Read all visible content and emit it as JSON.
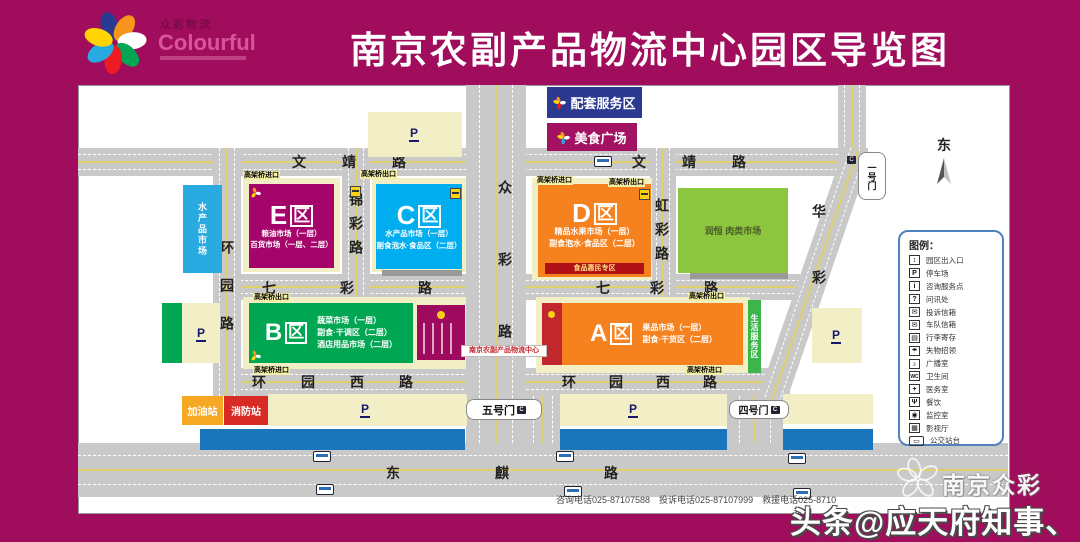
{
  "title": "南京农副产品物流中心园区导览图",
  "logo": {
    "cn": "众彩物流",
    "en": "Colourful"
  },
  "compass": {
    "east": "东"
  },
  "top_facilities": {
    "service_area": "配套服务区",
    "food_plaza": "美食广场"
  },
  "zones": {
    "E": {
      "letter": "E",
      "qu": "区",
      "lines": [
        "粮油市场（一层）",
        "百货市场（一层、二层）"
      ]
    },
    "C": {
      "letter": "C",
      "qu": "区",
      "lines": [
        "水产品市场（一层）",
        "副食泡水·食品区（二层）"
      ]
    },
    "D": {
      "letter": "D",
      "qu": "区",
      "lines": [
        "精品水果市场（一层）",
        "副食泡水·食品区（二层）"
      ],
      "strip": "食品惠民专区"
    },
    "B": {
      "letter": "B",
      "qu": "区",
      "lines": [
        "蔬菜市场（一层）",
        "副食·干调区（二层）",
        "酒店用品市场（二层）"
      ]
    },
    "A": {
      "letter": "A",
      "qu": "区",
      "lines": [
        "果品市场（一层）",
        "副食·干货区（二层）"
      ]
    }
  },
  "blocks": {
    "aquatic_market": "水产品市场",
    "runheng_meat_market": "润恒 肉类市场",
    "life_service_strip": "生活服务区",
    "gas_station": "加油站",
    "fire_station": "消防站",
    "center_banner": "南京农副产品物流中心"
  },
  "roads": {
    "wenjing": "文靖路",
    "qicai": "七彩路",
    "huanyuan_west": "环园西路",
    "dongqi": "东麒路",
    "huanyuan": "环园路",
    "jincai": "锦彩路",
    "zhongcai": "众彩路",
    "hongcai": "虹彩路",
    "huacai": "华彩"
  },
  "gates": {
    "gate1": "一号门",
    "gate4": "四号门",
    "gate5": "五号门"
  },
  "ramps": {
    "entry": "高架桥进口",
    "exit": "高架桥出口"
  },
  "parking_label": "P",
  "legend": {
    "title": "图例：",
    "items": [
      {
        "glyph": "↕",
        "label": "园区出入口"
      },
      {
        "glyph": "P",
        "label": "停车场"
      },
      {
        "glyph": "i",
        "label": "咨询服务点"
      },
      {
        "glyph": "?",
        "label": "问讯处"
      },
      {
        "glyph": "✉",
        "label": "投诉信箱"
      },
      {
        "glyph": "✉",
        "label": "车队信箱"
      },
      {
        "glyph": "▤",
        "label": "行李寄存"
      },
      {
        "glyph": "☂",
        "label": "失物招领"
      },
      {
        "glyph": "♪",
        "label": "广播室"
      },
      {
        "glyph": "WC",
        "label": "卫生间"
      },
      {
        "glyph": "+",
        "label": "医务室"
      },
      {
        "glyph": "Ψ",
        "label": "餐饮"
      },
      {
        "glyph": "◉",
        "label": "监控室"
      },
      {
        "glyph": "▦",
        "label": "影视厅"
      },
      {
        "glyph": "▭",
        "label": "公交站台"
      }
    ]
  },
  "footer": {
    "phones": "咨询电话025-87107588　投诉电话025-87107999　救援电话025-8710"
  },
  "watermarks": {
    "brand": "南京众彩",
    "byline": "头条@应天府知事、"
  }
}
